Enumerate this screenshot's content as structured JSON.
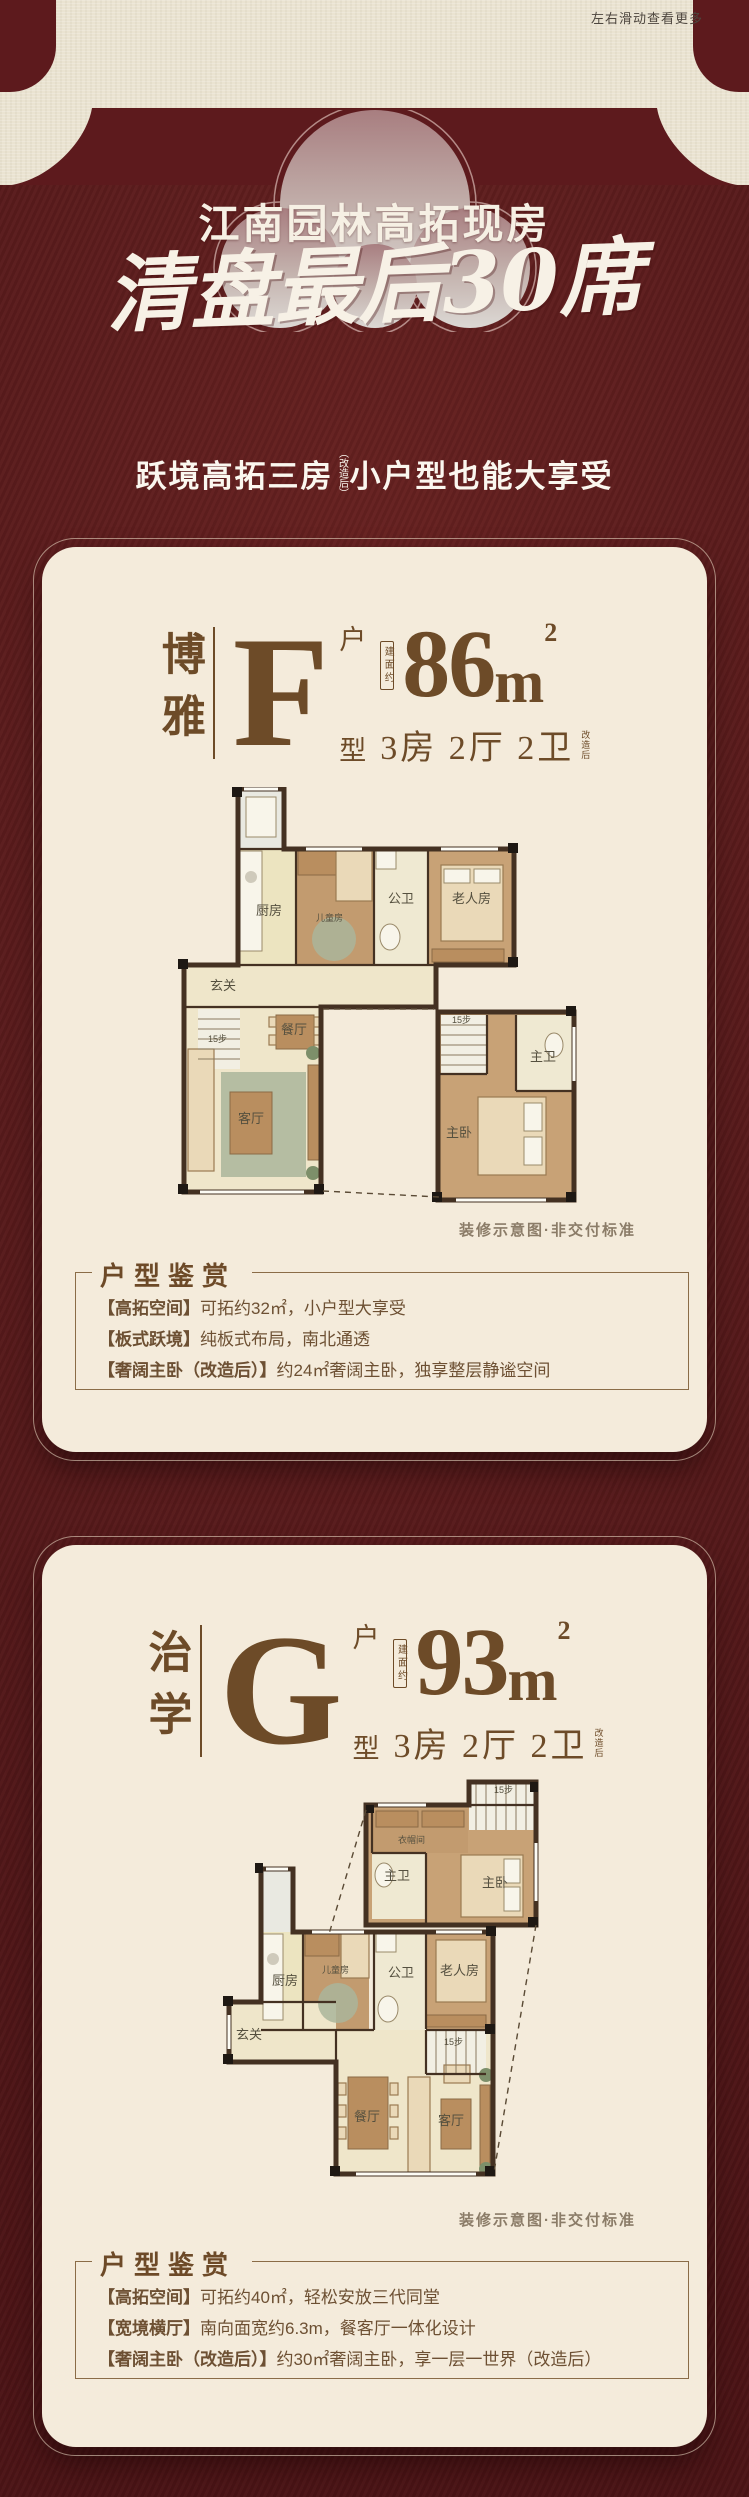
{
  "page": {
    "swipe_hint": "左右滑动查看更多"
  },
  "colors": {
    "maroon": "#5d1a1d",
    "beige": "#eae3d1",
    "card_cream": "#f4ebdb",
    "brown": "#6d4b28"
  },
  "hero": {
    "title": "江南园林高拓现房",
    "calligraphy": "清盘最后30席",
    "subtitle_left": "跃境高拓三房",
    "subtitle_note": "（改造后）",
    "subtitle_right": "小户型也能大享受"
  },
  "cards": [
    {
      "series_name": "博雅",
      "type_letter": "F",
      "unit_char_top": "户",
      "unit_char_bottom": "型",
      "area_note": "建面约",
      "area_value": "86",
      "area_unit": "m",
      "area_sup": "2",
      "layout_text": "3房 2厅 2卫",
      "layout_note": "改造后",
      "plan_caption": "装修示意图·非交付标准",
      "appreciation": {
        "title": "户型鉴赏",
        "items": [
          {
            "tag": "【高拓空间】",
            "text": "可拓约32㎡，小户型大享受"
          },
          {
            "tag": "【板式跃境】",
            "text": "纯板式布局，南北通透"
          },
          {
            "tag": "【奢阔主卧（改造后）】",
            "text": "约24㎡奢阔主卧，独享整层静谧空间"
          }
        ]
      },
      "plan_rooms": {
        "kitchen": "厨房",
        "kids": "儿童房",
        "guest_bath": "公卫",
        "elder": "老人房",
        "foyer": "玄关",
        "dining": "餐厅",
        "living": "客厅",
        "master_bath": "主卫",
        "master_bed": "主卧",
        "stairs_main": "15步",
        "stairs_suite": "15步"
      }
    },
    {
      "series_name": "治学",
      "type_letter": "G",
      "unit_char_top": "户",
      "unit_char_bottom": "型",
      "area_note": "建面约",
      "area_value": "93",
      "area_unit": "m",
      "area_sup": "2",
      "layout_text": "3房 2厅 2卫",
      "layout_note": "改造后",
      "plan_caption": "装修示意图·非交付标准",
      "appreciation": {
        "title": "户型鉴赏",
        "items": [
          {
            "tag": "【高拓空间】",
            "text": "可拓约40㎡，轻松安放三代同堂"
          },
          {
            "tag": "【宽境横厅】",
            "text": "南向面宽约6.3m，餐客厅一体化设计"
          },
          {
            "tag": "【奢阔主卧（改造后）】",
            "text": "约30㎡奢阔主卧，享一层一世界（改造后）"
          }
        ]
      },
      "plan_rooms": {
        "cloak": "衣帽间",
        "master_bath": "主卫",
        "master_bed": "主卧",
        "stairs_suite": "15步",
        "kitchen": "厨房",
        "kids": "儿童房",
        "guest_bath": "公卫",
        "elder": "老人房",
        "foyer": "玄关",
        "dining": "餐厅",
        "living": "客厅",
        "stairs_main": "15步"
      }
    }
  ]
}
